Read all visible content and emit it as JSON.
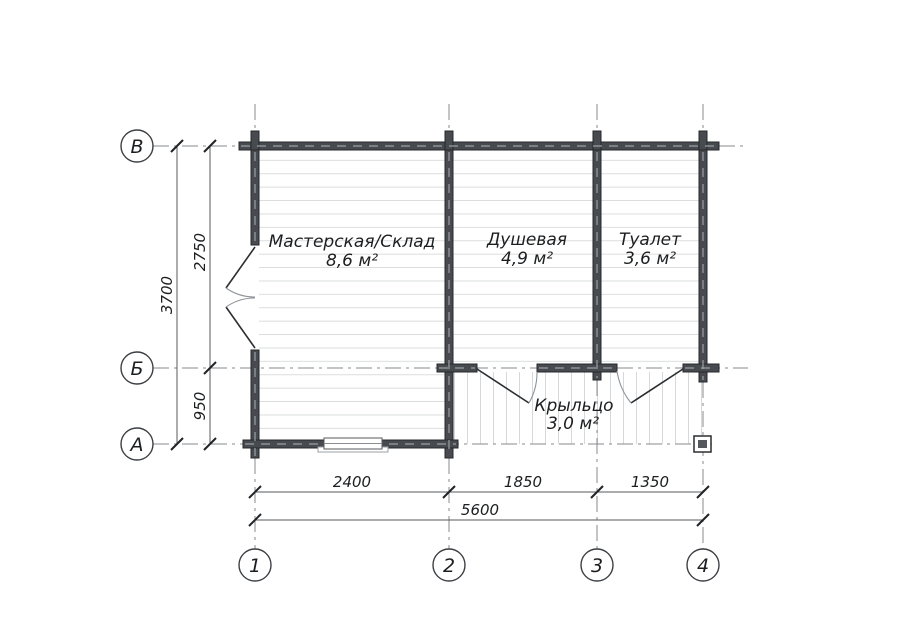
{
  "grid_axes": {
    "rows": [
      {
        "label": "В"
      },
      {
        "label": "Б"
      },
      {
        "label": "А"
      }
    ],
    "columns": [
      {
        "label": "1"
      },
      {
        "label": "2"
      },
      {
        "label": "3"
      },
      {
        "label": "4"
      }
    ]
  },
  "rooms": [
    {
      "name": "Мастерская/Склад",
      "area": "8,6 м²"
    },
    {
      "name": "Душевая",
      "area": "4,9 м²"
    },
    {
      "name": "Туалет",
      "area": "3,6 м²"
    },
    {
      "name": "Крыльцо",
      "area": "3,0 м²"
    }
  ],
  "dimensions": {
    "horizontal_segments": [
      "2400",
      "1850",
      "1350"
    ],
    "horizontal_total": "5600",
    "vertical_segments": [
      "2750",
      "950"
    ],
    "vertical_total": "3700"
  },
  "colors": {
    "wall": "#474b50",
    "wall_outline": "#26282b",
    "floor_line": "#d6d8da",
    "axis_line": "#85898e",
    "text": "#1c1e20"
  }
}
